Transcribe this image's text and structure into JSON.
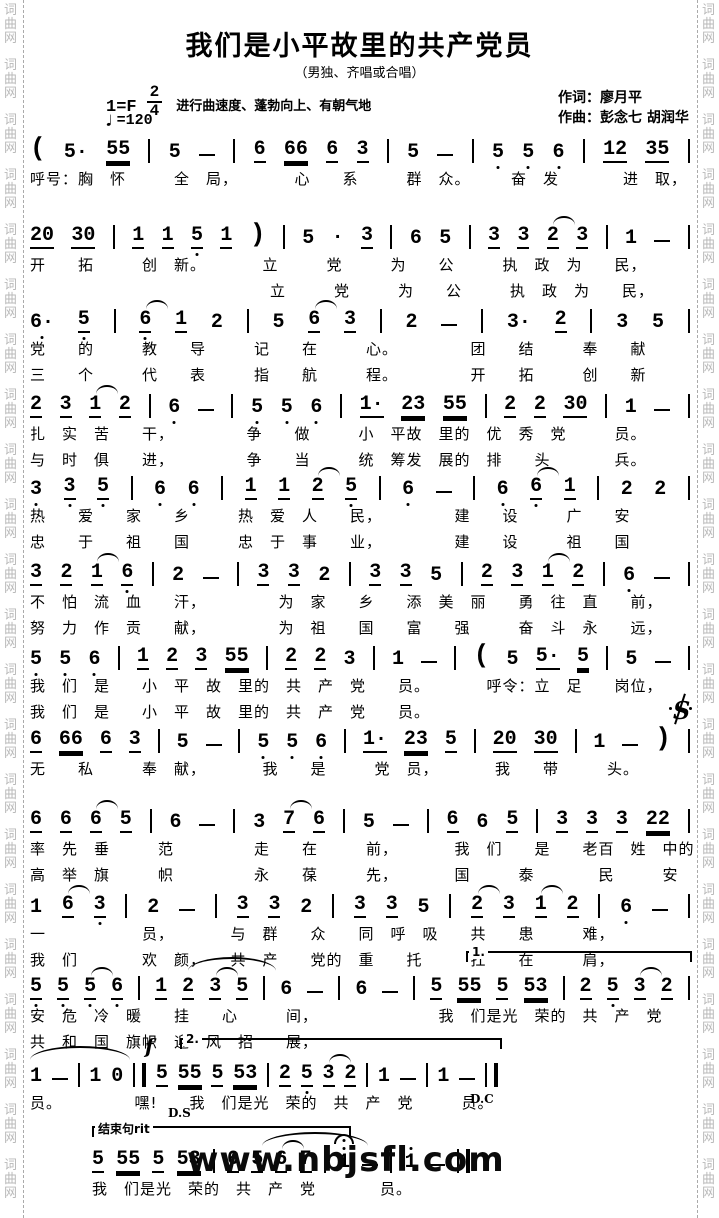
{
  "page": {
    "side_watermark": "词曲网",
    "site_watermark": "www.nbjsfl.com"
  },
  "header": {
    "title": "我们是小平故里的共产党员",
    "subtitle": "（男独、齐唱或合唱）",
    "key": "1=F",
    "meter_num": "2",
    "meter_den": "4",
    "tempo_text": "进行曲速度、蓬勃向上、有朝气地",
    "bpm_note": "♩",
    "bpm_value": "=120",
    "lyricist": "作词：廖月平",
    "composer": "作曲：彭念七  胡润华"
  },
  "score": {
    "systems": [
      {
        "top": 136,
        "left": 30,
        "width": 660,
        "tokens": [
          "(",
          "5·",
          "55=",
          "|",
          "5",
          "-",
          "|",
          "6_",
          "66=",
          "6_",
          "3_",
          "|",
          "5",
          "-",
          "|",
          "5,",
          "5,",
          "6,",
          "|",
          "12_",
          "35_",
          "|"
        ],
        "lyrics": [
          "呼号：胸　怀　　　全　局，　　　　心　　系　　　群　众。　　　奋　发　　　　进　取，"
        ]
      },
      {
        "top": 222,
        "left": 30,
        "width": 660,
        "tokens": [
          "20_",
          "30_",
          "|",
          "1_",
          "1_",
          "5,_",
          "1_",
          ")",
          "|",
          "5",
          "·",
          "3_",
          "|",
          "6",
          "5",
          "|",
          "3_",
          "3_",
          "2_~",
          "3_",
          "|",
          "1",
          "-",
          "|"
        ],
        "lyrics": [
          "开　　拓　　　创　新。　　　　立　　　党　　　为　　公　　　执　政　为　　民，",
          "　　　　　　　　　　　　　　　立　　　党　　　为　　公　　　执　政　为　　民，"
        ]
      },
      {
        "top": 306,
        "left": 30,
        "width": 660,
        "tokens": [
          "6·,",
          "5,_",
          "|",
          "6,_~",
          "1_",
          "2",
          "|",
          "5",
          "6_~",
          "3_",
          "|",
          "2",
          "-",
          "|",
          "3·",
          "2_",
          "|",
          "3",
          "5",
          "|"
        ],
        "lyrics": [
          "党　　的　　　教　　导　　　记　　在　　　心。　　　　　团　　结　　　奉　　献",
          "三　　个　　　代　　表　　　指　　航　　　程。　　　　　开　　拓　　　创　　新"
        ]
      },
      {
        "top": 391,
        "left": 30,
        "width": 660,
        "tokens": [
          "2_",
          "3_",
          "1_~",
          "2_",
          "|",
          "6,",
          "-",
          "|",
          "5,",
          "5,",
          "6,",
          "|",
          "1·_",
          "23=",
          "55=",
          "|",
          "2_",
          "2_",
          "30_",
          "|",
          "1",
          "-",
          "|"
        ],
        "lyrics": [
          "扎　实　苦　　干，　　　　　争　　做　　　小　平故　里的　优　秀　党　　　员。",
          "与　时　俱　　进，　　　　　争　　当　　　统　筹发　展的　排　　头　　　　兵。"
        ]
      },
      {
        "top": 473,
        "left": 30,
        "width": 660,
        "tokens": [
          "3,",
          "3,_",
          "5,_",
          "|",
          "6,",
          "6,",
          "|",
          "1_",
          "1_",
          "2_~",
          "5,_",
          "|",
          "6,",
          "-",
          "|",
          "6,",
          "6,_~",
          "1_",
          "|",
          "2",
          "2",
          "|"
        ],
        "lyrics": [
          "热　　爱　　家　　乡　　　热　爱　人　　民，　　　　　建　　设　　　广　　安",
          "忠　　于　　祖　　国　　　忠　于　事　　业，　　　　　建　　设　　　祖　　国"
        ]
      },
      {
        "top": 559,
        "left": 30,
        "width": 660,
        "tokens": [
          "3_",
          "2_",
          "1_~",
          "6,_",
          "|",
          "2",
          "-",
          "|",
          "3_",
          "3_",
          "2",
          "|",
          "3_",
          "3_",
          "5",
          "|",
          "2_",
          "3_",
          "1_~",
          "2_",
          "|",
          "6,",
          "-",
          "|"
        ],
        "lyrics": [
          "不　怕　流　血　　汗，　　　　　为　家　　乡　　添　美　丽　　勇　往　直　　前，",
          "努　力　作　贡　　献，　　　　　为　祖　　国　　富　　强　　　奋　斗　永　　远，"
        ]
      },
      {
        "top": 643,
        "left": 30,
        "width": 660,
        "tokens": [
          "5,",
          "5,",
          "6,",
          "|",
          "1_",
          "2_",
          "3_",
          "55=",
          "|",
          "2_",
          "2_",
          "3",
          "|",
          "1",
          "-",
          "|",
          "(",
          "5",
          "5·_",
          "5=",
          "|",
          "5",
          "-",
          "|"
        ],
        "lyrics": [
          "我　们　是　　小　平　故　里的　共　产　党　　员。　　　　呼令：立　足　　岗位，",
          "我　们　是　　小　平　故　里的　共　产　党　　员。"
        ]
      },
      {
        "top": 726,
        "left": 30,
        "width": 660,
        "tokens": [
          "6_",
          "66=",
          "6_",
          "3_",
          "|",
          "5",
          "-",
          "|",
          "5,",
          "5,",
          "6,",
          "|",
          "1·_",
          "23=",
          "5_",
          "|",
          "20_",
          "30_",
          "|",
          "1",
          "-",
          ")",
          "|"
        ],
        "lyrics": [
          "无　　私　　　奉　献，　　　　我　　是　　　党　员，　　　　我　　带　　　头。"
        ],
        "marks": [
          {
            "type": "segno",
            "name": "segno-icon",
            "left": 640,
            "top": -30
          }
        ]
      },
      {
        "top": 806,
        "left": 30,
        "width": 660,
        "tokens": [
          "6_",
          "6_",
          "6_~",
          "5_",
          "|",
          "6",
          "-",
          "|",
          "3",
          "7_~",
          "6_",
          "|",
          "5",
          "-",
          "|",
          "6_",
          "6",
          "5_",
          "|",
          "3_",
          "3_",
          "3_",
          "22=",
          "|"
        ],
        "lyrics": [
          "率　先　垂　　　范　　　　　走　　在　　　前，　　　　我　们　　是　　老百　姓　中的",
          "高　举　旗　　　帜　　　　　永　　葆　　　先，　　　　国　　　泰　　　　民　　　安"
        ]
      },
      {
        "top": 891,
        "left": 30,
        "width": 660,
        "tokens": [
          "1",
          "6_~",
          "3,_",
          "|",
          "2",
          "-",
          "|",
          "3_",
          "3_",
          "2",
          "|",
          "3_",
          "3_",
          "5",
          "|",
          "2_~",
          "3_",
          "1_~",
          "2_",
          "|",
          "6,",
          "-",
          "|"
        ],
        "lyrics": [
          "一　　　　　　员，　　　　与　群　　众　　同　呼　吸　　共　　患　　　难，",
          "我　们　　　　欢　颜，　　共　产　　党的　重　　托　　　扛　　在　　　肩，"
        ]
      },
      {
        "top": 973,
        "left": 30,
        "width": 660,
        "tokens": [
          "5,_",
          "5,_",
          "5,_~",
          "6,_",
          "|",
          "1_",
          "2_",
          "3_~",
          "5_",
          "|",
          "6",
          "-",
          "|",
          "6",
          "-",
          "|",
          "5_",
          "55=",
          "5_",
          "53=",
          "|",
          "2_",
          "5,_",
          "3_~",
          "2_",
          "|"
        ],
        "lyrics": [
          "安　危　冷　暖　　挂　　心　　　间，　　　　　　　　我　们是光　荣的　共　产　党",
          "共　和　国　旗帜　迎　风　招　　展，"
        ],
        "marks": [
          {
            "type": "slur",
            "name": "tie-arc",
            "left": 158,
            "top": -16,
            "width": 88
          },
          {
            "type": "volta",
            "name": "volta-1-bracket",
            "label": "1.",
            "left": 436,
            "top": -22,
            "width": 222
          }
        ]
      },
      {
        "top": 1060,
        "left": 30,
        "width": 468,
        "tokens": [
          "1",
          "-",
          "|",
          "1",
          "0",
          "‖",
          "5_",
          "55=",
          "5_",
          "53=",
          "|",
          "2_",
          "5,_",
          "3_~",
          "2_",
          "|",
          "1",
          "-",
          "|",
          "1",
          "-",
          "‖"
        ],
        "lyrics": [
          "员。　　　　　嘿!　　我　们是光　荣的　共　产　党　　　员。"
        ],
        "marks": [
          {
            "type": "slur",
            "name": "tie-arc",
            "left": 0,
            "top": -14,
            "width": 100
          },
          {
            "type": "text",
            "name": "forte-dynamic",
            "cls": "forte",
            "text": "f",
            "left": 115,
            "top": -26
          },
          {
            "type": "volta",
            "name": "volta-2-bracket",
            "label": "2.",
            "left": 150,
            "top": -22,
            "width": 318
          },
          {
            "type": "text",
            "name": "ds-marker",
            "cls": "nav",
            "text": "D.S",
            "left": 138,
            "top": 46
          },
          {
            "type": "text",
            "name": "dc-marker",
            "cls": "nav",
            "text": "D.C",
            "left": 440,
            "top": 32
          }
        ]
      },
      {
        "top": 1146,
        "left": 92,
        "width": 378,
        "tokens": [
          "5_",
          "55=",
          "5_",
          "53=",
          "|",
          "6_",
          "5_",
          "6_~",
          "7_",
          "|",
          "1'@",
          "-",
          "|",
          "1'",
          "-",
          "‖"
        ],
        "lyrics": [
          "我　们是光　荣的　共　产　党　　　　员。"
        ],
        "marks": [
          {
            "type": "volta",
            "name": "ending-phrase-bracket",
            "label": "结束句rit",
            "left": 0,
            "top": -20,
            "width": 255
          },
          {
            "type": "slur",
            "name": "tie-arc",
            "left": 170,
            "top": -14,
            "width": 106
          },
          {
            "type": "text",
            "name": "site-watermark",
            "cls": "sitemark",
            "text": "www.nbjsfl.com",
            "left": 95,
            "top": -6
          }
        ]
      }
    ]
  }
}
